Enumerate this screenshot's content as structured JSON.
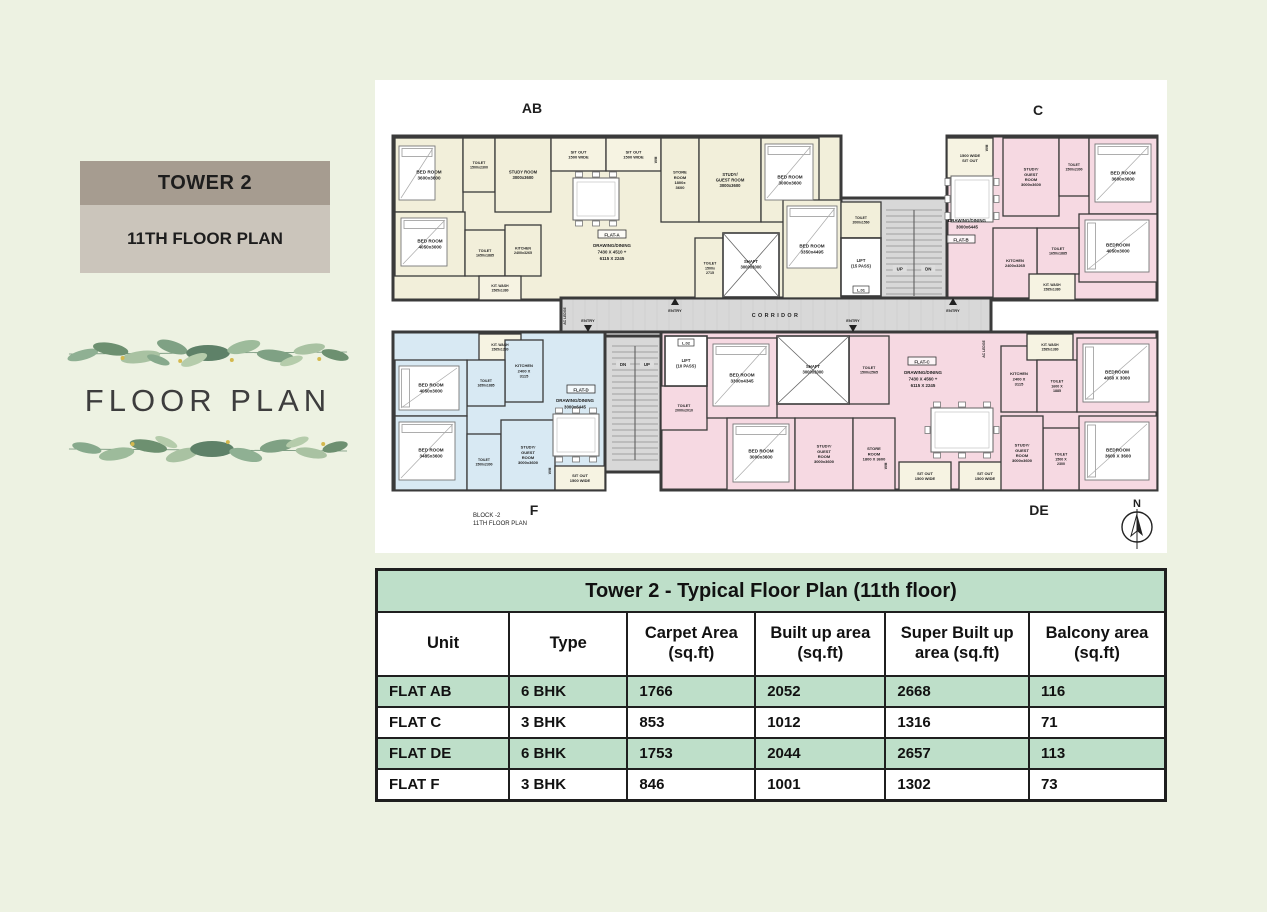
{
  "left_panel": {
    "tower_label": "TOWER 2",
    "floor_label": "11TH FLOOR PLAN",
    "decorative_title": "FLOOR PLAN",
    "band_top_color": "#a69c90",
    "band_bottom_color": "#cbc5bb"
  },
  "table": {
    "title": "Tower 2 - Typical Floor Plan (11th floor)",
    "columns": [
      "Unit",
      "Type",
      "Carpet Area (sq.ft)",
      "Built up area (sq.ft)",
      "Super Built up area (sq.ft)",
      "Balcony area (sq.ft)"
    ],
    "rows": [
      {
        "cells": [
          "FLAT AB",
          "6 BHK",
          "1766",
          "2052",
          "2668",
          "116"
        ],
        "highlight": true
      },
      {
        "cells": [
          "FLAT C",
          "3 BHK",
          "853",
          "1012",
          "1316",
          "71"
        ],
        "highlight": false
      },
      {
        "cells": [
          "FLAT DE",
          "6 BHK",
          "1753",
          "2044",
          "2657",
          "113"
        ],
        "highlight": true
      },
      {
        "cells": [
          "FLAT F",
          "3 BHK",
          "846",
          "1001",
          "1302",
          "73"
        ],
        "highlight": false
      }
    ],
    "header_green": "#bedfc9"
  },
  "floorplan": {
    "colors": {
      "ab": "#f2efda",
      "c": "#f6d9e2",
      "de": "#f6d9e2",
      "f": "#d8e9f3",
      "su": "#f6f3e2",
      "circ": "#d8d8d8",
      "wh": "#ffffff",
      "wall": "#3a3a3a"
    },
    "entry_label": "ENTRY",
    "slabs": [
      {
        "x": 18,
        "y": 56,
        "w": 448,
        "h": 164,
        "f": "ab"
      },
      {
        "x": 466,
        "y": 118,
        "w": 106,
        "h": 112,
        "f": "circ"
      },
      {
        "x": 572,
        "y": 56,
        "w": 210,
        "h": 164,
        "f": "c"
      },
      {
        "x": 186,
        "y": 218,
        "w": 430,
        "h": 34,
        "f": "circ",
        "tiled": true
      },
      {
        "x": 18,
        "y": 252,
        "w": 212,
        "h": 158,
        "f": "f"
      },
      {
        "x": 230,
        "y": 256,
        "w": 60,
        "h": 136,
        "f": "circ"
      },
      {
        "x": 286,
        "y": 252,
        "w": 496,
        "h": 158,
        "f": "de"
      }
    ],
    "rooms": [
      {
        "x": 20,
        "y": 58,
        "w": 68,
        "h": 74,
        "f": "ab",
        "t": [
          "BED ROOM",
          "3600x3600"
        ]
      },
      {
        "x": 88,
        "y": 58,
        "w": 32,
        "h": 54,
        "f": "ab",
        "t": [
          "TOILET",
          "1500x2300"
        ],
        "s": 3.6
      },
      {
        "x": 120,
        "y": 58,
        "w": 56,
        "h": 74,
        "f": "ab",
        "t": [
          "STUDY ROOM",
          "3000x3600"
        ],
        "s": 4.2
      },
      {
        "x": 176,
        "y": 58,
        "w": 55,
        "h": 33,
        "f": "su",
        "t": [
          "SIT OUT",
          "1500 WIDE"
        ],
        "s": 4
      },
      {
        "x": 231,
        "y": 58,
        "w": 55,
        "h": 33,
        "f": "su",
        "t": [
          "SIT OUT",
          "1500 WIDE"
        ],
        "s": 4
      },
      {
        "x": 286,
        "y": 58,
        "w": 38,
        "h": 84,
        "f": "ab",
        "t": [
          "STORE",
          "ROOM",
          "1800x",
          "3600"
        ],
        "s": 4
      },
      {
        "x": 324,
        "y": 58,
        "w": 62,
        "h": 84,
        "f": "ab",
        "t": [
          "STUDY/",
          "GUEST ROOM",
          "3000x3600"
        ],
        "s": 4.2
      },
      {
        "x": 386,
        "y": 58,
        "w": 58,
        "h": 84,
        "f": "ab",
        "t": [
          "BED ROOM",
          "3000x3600"
        ]
      },
      {
        "x": 20,
        "y": 132,
        "w": 70,
        "h": 64,
        "f": "ab",
        "t": [
          "BED ROOM",
          "4050x3000"
        ]
      },
      {
        "x": 90,
        "y": 150,
        "w": 40,
        "h": 46,
        "f": "ab",
        "t": [
          "TOILET",
          "1650x1885"
        ],
        "s": 3.6
      },
      {
        "x": 130,
        "y": 145,
        "w": 36,
        "h": 51,
        "f": "ab",
        "t": [
          "KITCHEN",
          "2400x3265"
        ],
        "s": 3.6
      },
      {
        "x": 104,
        "y": 196,
        "w": 42,
        "h": 24,
        "f": "su",
        "t": [
          "KIT. WASH",
          "1565x1380"
        ],
        "s": 3.4
      },
      {
        "x": 320,
        "y": 158,
        "w": 30,
        "h": 60,
        "f": "ab",
        "t": [
          "TOILET",
          "1500x",
          "2715"
        ],
        "s": 3.6
      },
      {
        "x": 408,
        "y": 120,
        "w": 58,
        "h": 98,
        "f": "ab",
        "t": [
          "BED ROOM",
          "3350x4495"
        ]
      },
      {
        "x": 466,
        "y": 122,
        "w": 40,
        "h": 36,
        "f": "ab",
        "t": [
          "TOILET",
          "2000x1560"
        ],
        "s": 3.4
      },
      {
        "x": 572,
        "y": 58,
        "w": 46,
        "h": 40,
        "f": "su",
        "t": [
          "1500 WIDE",
          "SIT OUT"
        ],
        "s": 4
      },
      {
        "x": 628,
        "y": 58,
        "w": 56,
        "h": 78,
        "f": "c",
        "t": [
          "STUDY/",
          "GUEST",
          "ROOM",
          "3000x3600"
        ],
        "s": 4
      },
      {
        "x": 684,
        "y": 58,
        "w": 30,
        "h": 58,
        "f": "c",
        "t": [
          "TOILET",
          "1500x2300"
        ],
        "s": 3.4
      },
      {
        "x": 714,
        "y": 58,
        "w": 68,
        "h": 76,
        "f": "c",
        "t": [
          "BED ROOM",
          "3600x3600"
        ]
      },
      {
        "x": 704,
        "y": 134,
        "w": 78,
        "h": 68,
        "f": "c",
        "t": [
          "BEDROOM",
          "4050x3000"
        ]
      },
      {
        "x": 662,
        "y": 148,
        "w": 42,
        "h": 46,
        "f": "c",
        "t": [
          "TOILET",
          "1650x1885"
        ],
        "s": 3.6
      },
      {
        "x": 618,
        "y": 148,
        "w": 44,
        "h": 70,
        "f": "c",
        "t": [
          "KITCHEN",
          "2400x3265"
        ],
        "s": 4
      },
      {
        "x": 654,
        "y": 194,
        "w": 46,
        "h": 26,
        "f": "su",
        "t": [
          "KIT. WASH",
          "1585x1380"
        ],
        "s": 3.4
      },
      {
        "x": 286,
        "y": 306,
        "w": 46,
        "h": 44,
        "f": "de",
        "t": [
          "TOILET",
          "2000x2010"
        ],
        "s": 3.6
      },
      {
        "x": 332,
        "y": 258,
        "w": 70,
        "h": 80,
        "f": "de",
        "t": [
          "BED ROOM",
          "3300x4345"
        ]
      },
      {
        "x": 474,
        "y": 256,
        "w": 40,
        "h": 68,
        "f": "de",
        "t": [
          "TOILET",
          "1500x2565"
        ],
        "s": 3.6
      },
      {
        "x": 352,
        "y": 338,
        "w": 68,
        "h": 72,
        "f": "de",
        "t": [
          "BED ROOM",
          "3000x3600"
        ]
      },
      {
        "x": 420,
        "y": 338,
        "w": 58,
        "h": 72,
        "f": "de",
        "t": [
          "STUDY/",
          "GUEST",
          "ROOM",
          "3000x3600"
        ],
        "s": 4
      },
      {
        "x": 478,
        "y": 338,
        "w": 42,
        "h": 72,
        "f": "de",
        "t": [
          "STORE",
          "ROOM",
          "1800 X 3600"
        ],
        "s": 4
      },
      {
        "x": 524,
        "y": 382,
        "w": 52,
        "h": 28,
        "f": "su",
        "t": [
          "SIT OUT",
          "1500 WIDE"
        ],
        "s": 4
      },
      {
        "x": 584,
        "y": 382,
        "w": 52,
        "h": 28,
        "f": "su",
        "t": [
          "SIT OUT",
          "1500 WIDE"
        ],
        "s": 4
      },
      {
        "x": 626,
        "y": 266,
        "w": 36,
        "h": 66,
        "f": "de",
        "t": [
          "KITCHEN",
          "2400 X",
          "3115"
        ],
        "s": 4
      },
      {
        "x": 652,
        "y": 254,
        "w": 46,
        "h": 26,
        "f": "su",
        "t": [
          "KIT. WASH",
          "1585x1380"
        ],
        "s": 3.4
      },
      {
        "x": 662,
        "y": 280,
        "w": 40,
        "h": 52,
        "f": "de",
        "t": [
          "TOILET",
          "1600 X",
          "1885"
        ],
        "s": 3.6
      },
      {
        "x": 702,
        "y": 258,
        "w": 80,
        "h": 74,
        "f": "de",
        "t": [
          "BEDROOM",
          "4050 X 3000"
        ]
      },
      {
        "x": 704,
        "y": 336,
        "w": 78,
        "h": 74,
        "f": "de",
        "t": [
          "BEDROOM",
          "3600 X 3600"
        ]
      },
      {
        "x": 668,
        "y": 348,
        "w": 36,
        "h": 62,
        "f": "de",
        "t": [
          "TOILET",
          "1500 X",
          "2300"
        ],
        "s": 3.6
      },
      {
        "x": 626,
        "y": 336,
        "w": 42,
        "h": 74,
        "f": "de",
        "t": [
          "STUDY/",
          "GUEST",
          "ROOM",
          "3000x3600"
        ],
        "s": 4
      },
      {
        "x": 104,
        "y": 254,
        "w": 42,
        "h": 26,
        "f": "su",
        "t": [
          "KIT. WASH",
          "1565x1230"
        ],
        "s": 3.4
      },
      {
        "x": 130,
        "y": 260,
        "w": 38,
        "h": 62,
        "f": "f",
        "t": [
          "KITCHEN",
          "2400 X",
          "3115"
        ],
        "s": 4
      },
      {
        "x": 92,
        "y": 280,
        "w": 38,
        "h": 46,
        "f": "f",
        "t": [
          "TOILET",
          "1650x1885"
        ],
        "s": 3.4
      },
      {
        "x": 20,
        "y": 280,
        "w": 72,
        "h": 56,
        "f": "f",
        "t": [
          "BED ROOM",
          "4050x3000"
        ]
      },
      {
        "x": 20,
        "y": 336,
        "w": 72,
        "h": 74,
        "f": "f",
        "t": [
          "BED ROOM",
          "3485x3600"
        ]
      },
      {
        "x": 92,
        "y": 354,
        "w": 34,
        "h": 56,
        "f": "f",
        "t": [
          "TOILET",
          "1500x2300"
        ],
        "s": 3.4
      },
      {
        "x": 126,
        "y": 340,
        "w": 54,
        "h": 70,
        "f": "f",
        "t": [
          "STUDY/",
          "GUEST",
          "ROOM",
          "3000x3600"
        ],
        "s": 4
      },
      {
        "x": 180,
        "y": 386,
        "w": 50,
        "h": 24,
        "f": "su",
        "t": [
          "SIT OUT",
          "1500 WIDE"
        ],
        "s": 4
      }
    ],
    "shafts": [
      {
        "x": 348,
        "y": 153,
        "w": 56,
        "h": 64,
        "t": [
          "SHAFT",
          "3000x3000"
        ]
      },
      {
        "x": 402,
        "y": 256,
        "w": 72,
        "h": 68,
        "t": [
          "SHAFT",
          "3000x3000"
        ]
      }
    ],
    "lifts": [
      {
        "x": 466,
        "y": 158,
        "w": 40,
        "h": 58,
        "tag": "L.01",
        "t": [
          "LIFT",
          "(15 PASS)"
        ],
        "tagpos": "bottom"
      },
      {
        "x": 290,
        "y": 256,
        "w": 42,
        "h": 50,
        "tag": "L.02",
        "t": [
          "LIFT",
          "(10 PASS)"
        ],
        "tagpos": "top"
      }
    ],
    "stairs": [
      {
        "x": 508,
        "y": 124,
        "w": 62,
        "h": 100,
        "l1": "UP",
        "l2": "DN",
        "ly": 0.66
      },
      {
        "x": 234,
        "y": 260,
        "w": 52,
        "h": 128,
        "l1": "DN",
        "l2": "UP",
        "ly": 0.2
      }
    ],
    "flat_tags": [
      {
        "x": 237,
        "y": 155,
        "t": "FLAT-A"
      },
      {
        "x": 586,
        "y": 160,
        "t": "FLAT-B"
      },
      {
        "x": 547,
        "y": 282,
        "t": "FLAT-C"
      },
      {
        "x": 206,
        "y": 310,
        "t": "FLAT-D"
      }
    ],
    "annotations": [
      {
        "x": 237,
        "y": 167,
        "lines": [
          "DRAWING/DINING",
          "7430 X 4510 +",
          "6115 X 2245"
        ],
        "s": 4.4
      },
      {
        "x": 592,
        "y": 142,
        "lines": [
          "DRAWING/DINING",
          "3000x6445"
        ],
        "s": 4.4
      },
      {
        "x": 548,
        "y": 294,
        "lines": [
          "DRAWING/DINING",
          "7430 X 4560 +",
          "6115 X 2245"
        ],
        "s": 4.4
      },
      {
        "x": 200,
        "y": 322,
        "lines": [
          "DRAWING/DINING",
          "3000x6445"
        ],
        "s": 4.4
      },
      {
        "x": 401,
        "y": 237,
        "lines": [
          "CORRIDOR"
        ],
        "s": 5.4,
        "ls": 2.4
      },
      {
        "x": 191,
        "y": 236,
        "lines": [
          "AC LEDGE"
        ],
        "s": 3.4,
        "rot": -90
      },
      {
        "x": 610,
        "y": 269,
        "lines": [
          "AC LEDGE"
        ],
        "s": 3.4,
        "rot": -90
      },
      {
        "x": 282,
        "y": 80,
        "lines": [
          "W/M"
        ],
        "s": 3.2,
        "rot": -90
      },
      {
        "x": 613,
        "y": 68,
        "lines": [
          "W/M"
        ],
        "s": 3.2,
        "rot": -90
      },
      {
        "x": 512,
        "y": 386,
        "lines": [
          "W/M"
        ],
        "s": 3.2,
        "rot": -90
      },
      {
        "x": 176,
        "y": 391,
        "lines": [
          "W/M"
        ],
        "s": 3.2,
        "rot": -90
      }
    ],
    "entries": [
      {
        "x": 300,
        "y": 222,
        "dir": "up"
      },
      {
        "x": 578,
        "y": 222,
        "dir": "up"
      },
      {
        "x": 213,
        "y": 248,
        "dir": "down"
      },
      {
        "x": 478,
        "y": 248,
        "dir": "down"
      }
    ],
    "unit_labels": [
      {
        "t": "AB",
        "x": 157,
        "y": 33
      },
      {
        "t": "C",
        "x": 663,
        "y": 35
      },
      {
        "t": "F",
        "x": 159,
        "y": 435
      },
      {
        "t": "DE",
        "x": 664,
        "y": 435
      }
    ],
    "block_caption": {
      "x": 98,
      "y": 437,
      "lines": [
        "BLOCK -2",
        "11TH FLOOR PLAN"
      ]
    },
    "compass": {
      "x": 762,
      "y": 447,
      "r": 15,
      "label": "N"
    },
    "tables": [
      {
        "x": 198,
        "y": 98,
        "w": 46,
        "h": 42,
        "seats": 6
      },
      {
        "x": 576,
        "y": 96,
        "w": 42,
        "h": 46,
        "seats": 6
      },
      {
        "x": 556,
        "y": 328,
        "w": 62,
        "h": 44,
        "seats": 8
      },
      {
        "x": 178,
        "y": 334,
        "w": 46,
        "h": 42,
        "seats": 6
      }
    ],
    "beds": [
      {
        "x": 24,
        "y": 66,
        "w": 36,
        "h": 54
      },
      {
        "x": 26,
        "y": 138,
        "w": 46,
        "h": 48
      },
      {
        "x": 390,
        "y": 64,
        "w": 48,
        "h": 56
      },
      {
        "x": 412,
        "y": 126,
        "w": 50,
        "h": 62
      },
      {
        "x": 720,
        "y": 64,
        "w": 56,
        "h": 58
      },
      {
        "x": 710,
        "y": 140,
        "w": 64,
        "h": 52
      },
      {
        "x": 338,
        "y": 264,
        "w": 56,
        "h": 62
      },
      {
        "x": 358,
        "y": 344,
        "w": 56,
        "h": 58
      },
      {
        "x": 708,
        "y": 264,
        "w": 66,
        "h": 58
      },
      {
        "x": 710,
        "y": 342,
        "w": 64,
        "h": 58
      },
      {
        "x": 24,
        "y": 286,
        "w": 60,
        "h": 44
      },
      {
        "x": 24,
        "y": 342,
        "w": 56,
        "h": 58
      }
    ]
  }
}
